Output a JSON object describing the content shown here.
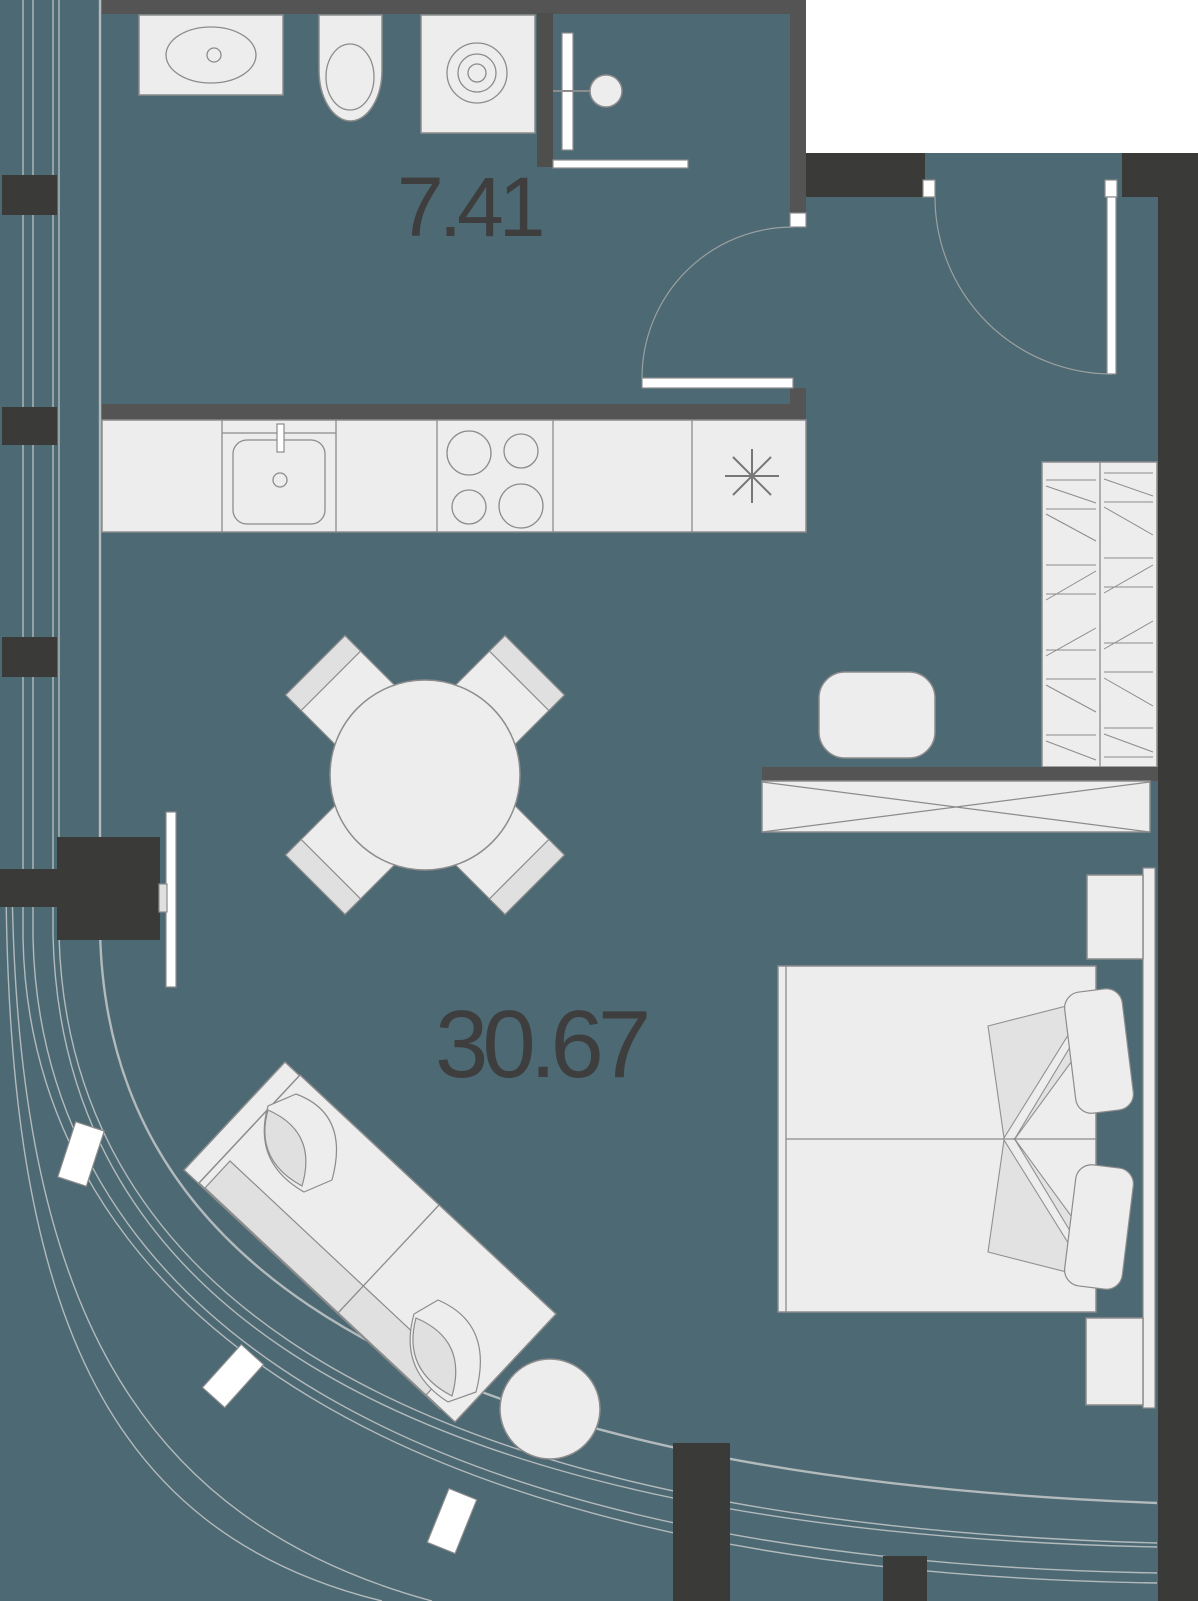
{
  "floorplan": {
    "rooms": [
      {
        "id": "bathroom",
        "area_label": "7.41"
      },
      {
        "id": "living-room",
        "area_label": "30.67"
      }
    ],
    "colors": {
      "background": "#4d6973",
      "outside": "#ffffff",
      "wall_dark": "#3a3a38",
      "wall_gray": "#545454",
      "furniture_fill": "#ededed",
      "furniture_stroke": "#8c8c8c",
      "cushion_band": "#e0e0e0",
      "blanket_fill": "#e2e2e2",
      "glazing_line": "#b3babc",
      "door_arc": "#9aa0a0",
      "label_text": "#3e3e3e"
    },
    "icons": [
      "bathroom-sink-icon",
      "toilet-icon",
      "washing-machine-icon",
      "shower-icon",
      "kitchen-sink-icon",
      "stove-icon",
      "fridge-snowflake-icon",
      "dining-table-icon",
      "dining-chair-icon",
      "tv-icon",
      "sofa-icon",
      "side-table-icon",
      "wardrobe-icon",
      "desk-icon",
      "desk-chair-icon",
      "bed-icon",
      "pillow-icon",
      "nightstand-icon",
      "door-swing-icon",
      "window-post-icon",
      "column-icon"
    ]
  }
}
